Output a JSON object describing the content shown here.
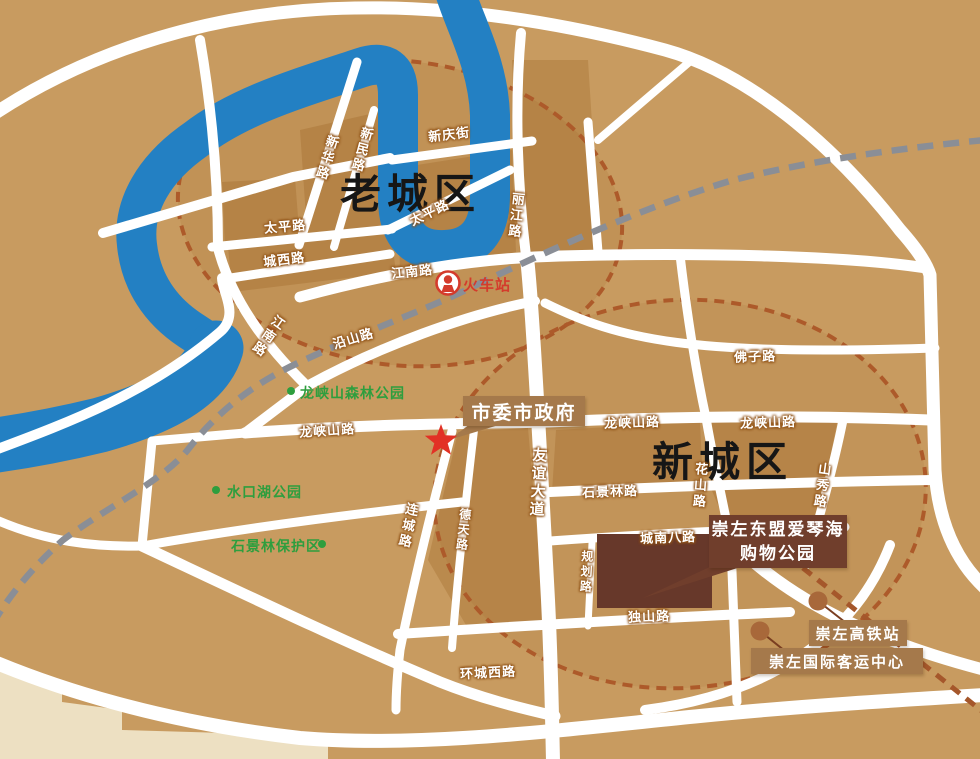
{
  "districts": {
    "old": "老城区",
    "new": "新城区"
  },
  "landmarks": {
    "government": "市委市政府",
    "railway_station": "火车站",
    "shopping_park_line1": "崇左东盟爱琴海",
    "shopping_park_line2": "购物公园",
    "hsr_station": "崇左高铁站",
    "intl_bus_center": "崇左国际客运中心"
  },
  "parks": {
    "forest_park": "龙峡山森林公园",
    "lake_park": "水口湖公园",
    "reserve": "石景林保护区"
  },
  "roads": {
    "xinhua": "新华路",
    "xinmin": "新民路",
    "xinqing": "新庆街",
    "taiping_w": "太平路",
    "taiping_e": "太平路",
    "chengxi": "城西路",
    "lijiang": "丽江路",
    "jiangnan_h": "江南路",
    "jiangnan_v": "江南路",
    "yanshan": "沿山路",
    "longxiashan_w": "龙峡山路",
    "longxiashan_m": "龙峡山路",
    "longxiashan_e": "龙峡山路",
    "youyi": "友谊大道",
    "shijinglin": "石景林路",
    "huashan": "花山路",
    "shanxiu": "山秀路",
    "fozi": "佛子路",
    "liancheng": "连城路",
    "detian": "德天路",
    "chengnanba": "城南八路",
    "guihua": "规划路",
    "dushan": "独山路",
    "huanchengxi": "环城西路"
  },
  "colors": {
    "background": "#C89B60",
    "block": "#BA8A4D",
    "river": "#2380C3",
    "road": "#FFFFFF",
    "railway_dash": "#8A8E96",
    "district_dash": "#AD5A2A",
    "label_box": "#A5794B",
    "shopping_box": "#703E2C",
    "park_green": "#2E9E3E",
    "station_red": "#D43B2C",
    "star_red": "#E23125",
    "cream_area": "#EDE0C2"
  }
}
